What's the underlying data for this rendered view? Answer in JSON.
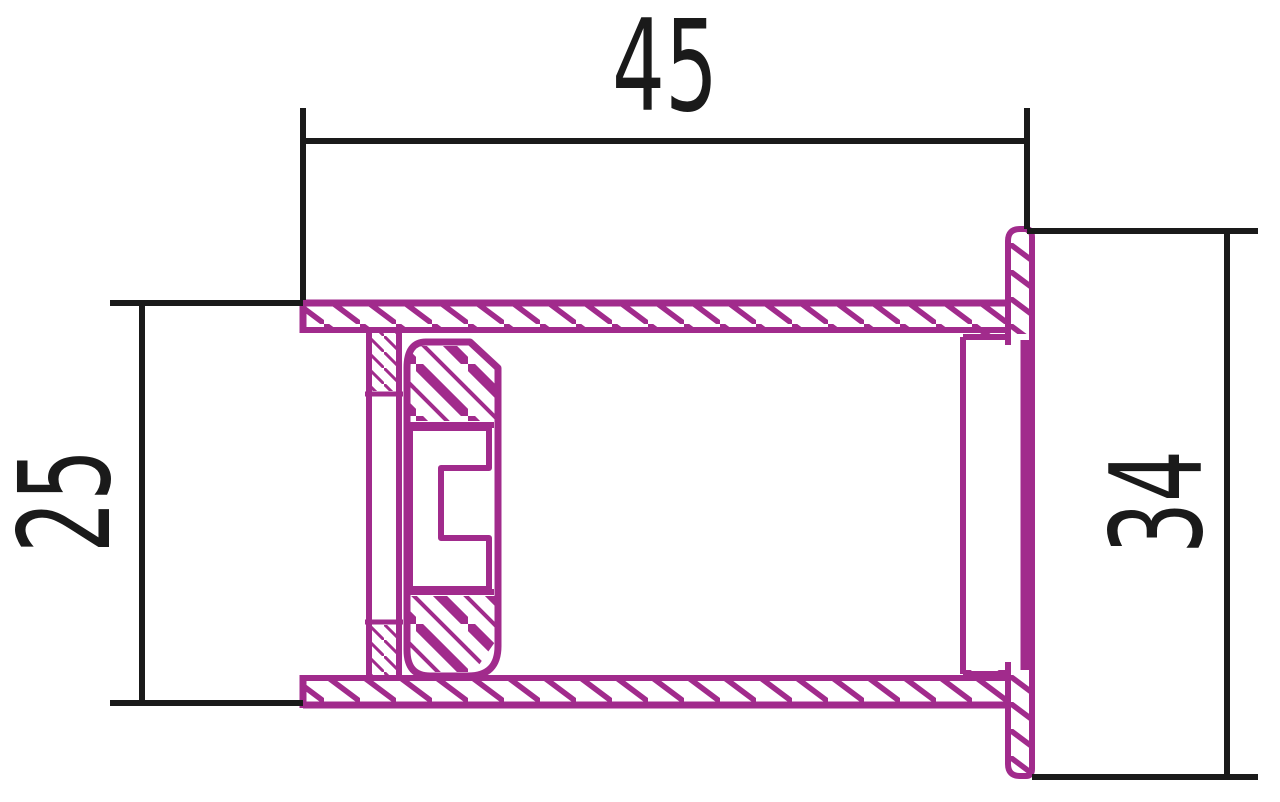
{
  "drawing": {
    "title": "flanged-bushing-section",
    "view": "cross-section",
    "part_color": "#A12B8C",
    "line_color": "#1A1A1A",
    "background_color": "#FFFFFF"
  },
  "dimensions": {
    "length": {
      "value": "45",
      "orientation": "horizontal",
      "position": "top"
    },
    "outer_diameter": {
      "value": "25",
      "orientation": "vertical",
      "position": "left"
    },
    "flange_diameter": {
      "value": "34",
      "orientation": "vertical",
      "position": "right"
    }
  }
}
